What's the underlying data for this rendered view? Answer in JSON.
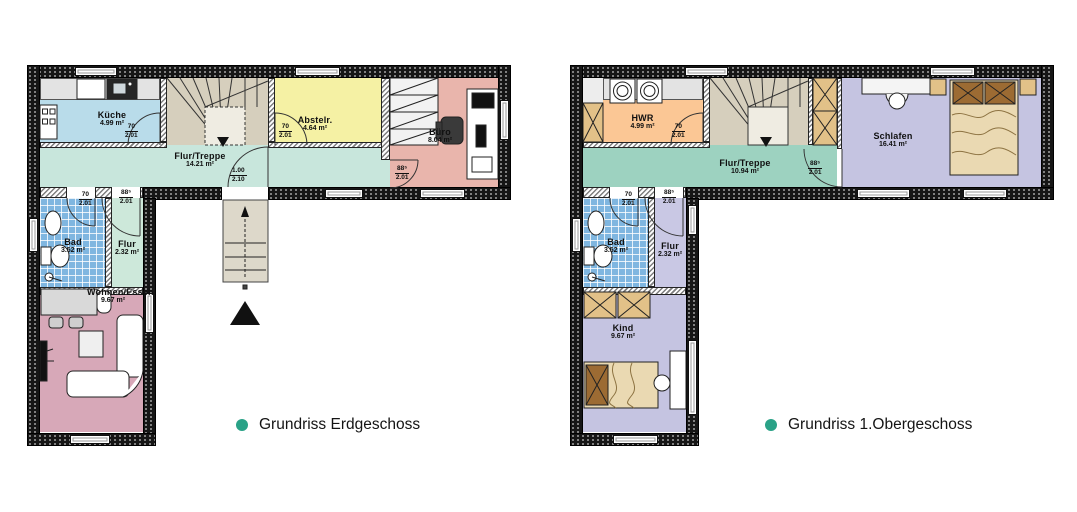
{
  "plans": {
    "eg": {
      "caption": "Grundriss Erdgeschoss",
      "rooms": {
        "kueche": {
          "label": "Küche",
          "area": "4.99 m²"
        },
        "flur_treppe": {
          "label": "Flur/Treppe",
          "area": "14.21 m²"
        },
        "abstellraum": {
          "label": "Abstelr.",
          "area": "4.64 m²"
        },
        "buero": {
          "label": "Büro",
          "area": "8.04 m²"
        },
        "bad": {
          "label": "Bad",
          "area": "3.52 m²"
        },
        "flur": {
          "label": "Flur",
          "area": "2.32 m²"
        },
        "wohnen_essen": {
          "label": "Wohnen/Essen",
          "area": "9.67 m²"
        }
      },
      "doors": {
        "kueche": {
          "w": "70",
          "h": "2.01"
        },
        "abstellraum": {
          "w": "70",
          "h": "2.01"
        },
        "buero": {
          "w": "88⁵",
          "h": "2.01"
        },
        "entrance": {
          "w": "1.00",
          "h": "2.10"
        },
        "bad": {
          "w": "70",
          "h": "2.01"
        },
        "flur": {
          "w": "88⁵",
          "h": "2.01"
        }
      }
    },
    "og": {
      "caption": "Grundriss 1.Obergeschoss",
      "rooms": {
        "hwr": {
          "label": "HWR",
          "area": "4.99 m²"
        },
        "flur_treppe": {
          "label": "Flur/Treppe",
          "area": "10.94 m²"
        },
        "schlafen": {
          "label": "Schlafen",
          "area": "16.41 m²"
        },
        "bad": {
          "label": "Bad",
          "area": "3.52 m²"
        },
        "flur": {
          "label": "Flur",
          "area": "2.32 m²"
        },
        "kind": {
          "label": "Kind",
          "area": "9.67 m²"
        }
      },
      "doors": {
        "hwr": {
          "w": "70",
          "h": "2.01"
        },
        "schlafen": {
          "w": "88⁵",
          "h": "2.01"
        },
        "bad": {
          "w": "70",
          "h": "2.01"
        },
        "flur": {
          "w": "88⁵",
          "h": "2.01"
        }
      }
    }
  },
  "colors": {
    "accent_dot": "#2aa287",
    "wall": "#161616",
    "kueche": "#b9dcea",
    "flur_treppe_eg": "#c8e6dc",
    "abstellraum": "#f5f1a4",
    "buero": "#e9b5ac",
    "bad": "#7fb6e0",
    "flur_eg": "#cde8da",
    "wohnen_essen": "#d7a8b8",
    "stairs": "#d6cfbd",
    "hwr": "#fbc795",
    "flur_treppe_og": "#9dd2c0",
    "schlafen": "#c5c4e1",
    "flur_og": "#c9c8e4",
    "kind": "#c5c4e1",
    "furniture_wood": "#e2c188",
    "bed": "#ead9b2"
  }
}
